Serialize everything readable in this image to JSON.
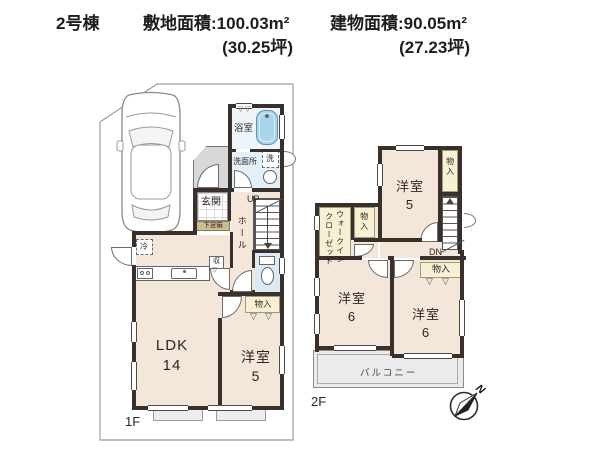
{
  "header": {
    "building_no": "2号棟",
    "land_area": "敷地面積:100.03m²",
    "land_area_tsubo": "(30.25坪)",
    "building_area": "建物面積:90.05m²",
    "building_area_tsubo": "(27.23坪)"
  },
  "floor1": {
    "label": "1F",
    "ldk_name": "LDK",
    "ldk_size": "14",
    "bedroom_name": "洋室",
    "bedroom_size": "5",
    "entrance": "玄関",
    "shoe_box": "下足箱",
    "hall": "ホール",
    "bath": "浴室",
    "washroom": "洗面所",
    "washer": "洗",
    "fridge": "冷",
    "cupboard": "収",
    "storage": "物入",
    "up": "UP",
    "fold_symbol": "▽"
  },
  "floor2": {
    "label": "2F",
    "bedroom5_name": "洋室",
    "bedroom5_size": "5",
    "bedroom6a_name": "洋室",
    "bedroom6a_size": "6",
    "bedroom6b_name": "洋室",
    "bedroom6b_size": "6",
    "wic_line1": "ウォークイン",
    "wic_line2": "クローゼット",
    "storage_top": "物入",
    "storage_left": "物入",
    "storage_right": "物入",
    "balcony": "バルコニー",
    "dn": "DN",
    "fold_symbol": "▽"
  },
  "compass": {
    "north_label": "N"
  },
  "colors": {
    "wall": "#3a302b",
    "floor": "#f4e6d9",
    "storage": "#f7f1d3",
    "water": "#dceaf5",
    "tub": "#a9d6ec"
  }
}
